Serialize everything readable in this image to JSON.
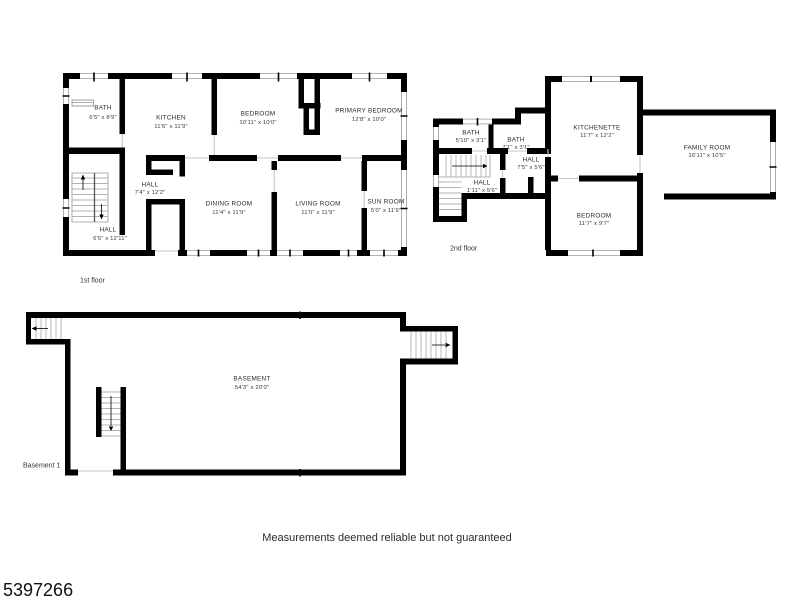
{
  "page": {
    "footer_disclaimer": "Measurements deemed reliable but not guaranteed",
    "listing_id": "5397266"
  },
  "colors": {
    "wall": "#000000",
    "stair_tread": "#b3b3b3",
    "window_line": "#9a9a9a",
    "door_line": "#c6c6c6",
    "text": "#2b2b2b"
  },
  "floors": {
    "first": {
      "caption": "1st floor",
      "rooms": [
        {
          "name": "BATH",
          "dims": "6'5\" x 8'9\""
        },
        {
          "name": "KITCHEN",
          "dims": "11'6\" x 11'9\""
        },
        {
          "name": "BEDROOM",
          "dims": "10'11\" x 10'0\""
        },
        {
          "name": "PRIMARY BEDROOM",
          "dims": "12'8\" x 10'0\""
        },
        {
          "name": "HALL",
          "dims": "7'4\" x 12'2\""
        },
        {
          "name": "HALL",
          "dims": "6'5\" x 12'11\""
        },
        {
          "name": "DINING ROOM",
          "dims": "11'4\" x 11'9\""
        },
        {
          "name": "LIVING ROOM",
          "dims": "11'0\" x 11'9\""
        },
        {
          "name": "SUN ROOM",
          "dims": "5'0\" x 11'9\""
        }
      ]
    },
    "second": {
      "caption": "2nd floor",
      "rooms": [
        {
          "name": "BATH",
          "dims": "5'10\" x 3'1\""
        },
        {
          "name": "BATH",
          "dims": "7'1\" x 3'1\""
        },
        {
          "name": "HALL",
          "dims": "7'5\" x 5'6\""
        },
        {
          "name": "HALL",
          "dims": "1'11\" x 5'6\""
        },
        {
          "name": "KITCHENETTE",
          "dims": "11'7\" x 12'2\""
        },
        {
          "name": "FAMILY ROOM",
          "dims": "16'11\" x 10'5\""
        },
        {
          "name": "BEDROOM",
          "dims": "11'7\" x 9'7\""
        }
      ]
    },
    "basement": {
      "caption": "Basement 1",
      "rooms": [
        {
          "name": "BASEMENT",
          "dims": "54'3\" x 20'0\""
        }
      ]
    }
  }
}
